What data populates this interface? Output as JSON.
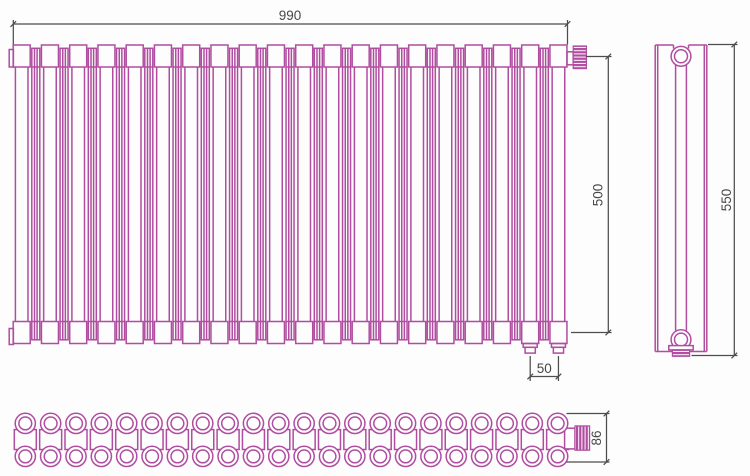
{
  "colors": {
    "line": "#b04da0",
    "dimension_line": "#4d4d4d",
    "dimension_text": "#474747",
    "background": "#fdfdfd"
  },
  "dimensions": {
    "overall_width": "990",
    "valve_to_bottom_height": "500",
    "overall_height": "550",
    "bottom_connection_spacing": "50",
    "depth": "86"
  },
  "front_view": {
    "tube_count": 20
  },
  "bottom_view": {
    "column_count": 22,
    "row_count": 2
  }
}
